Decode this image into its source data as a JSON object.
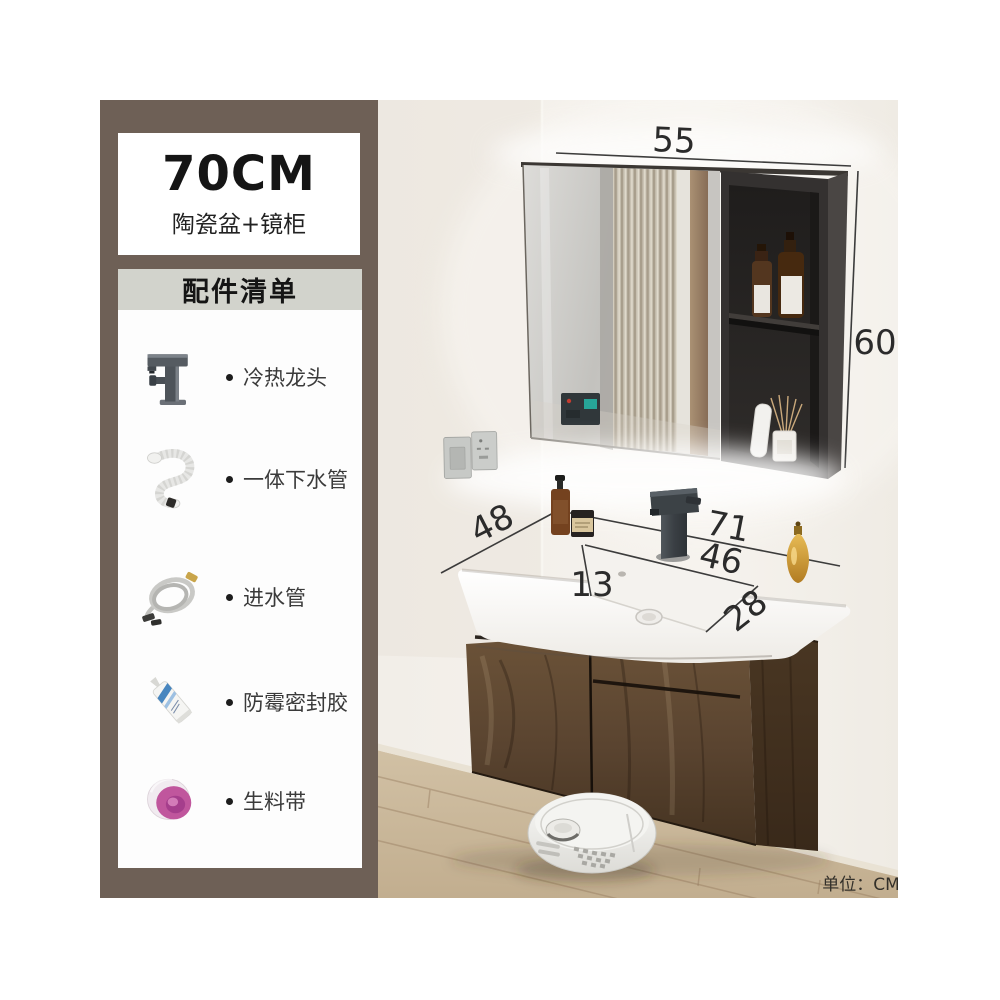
{
  "sidebar": {
    "size_card": {
      "size": "70CM",
      "subtitle": "陶瓷盆+镜柜"
    },
    "accessories": {
      "header": "配件清单",
      "items": [
        {
          "label": "冷热龙头",
          "icon": "faucet-icon"
        },
        {
          "label": "一体下水管",
          "icon": "drain-pipe-icon"
        },
        {
          "label": "进水管",
          "icon": "water-inlet-hose-icon"
        },
        {
          "label": "防霉密封胶",
          "icon": "sealant-tube-icon"
        },
        {
          "label": "生料带",
          "icon": "thread-seal-tape-icon"
        }
      ]
    }
  },
  "scene": {
    "dimensions": {
      "mirror_cabinet_width_cm": "55",
      "mirror_cabinet_height_cm": "60",
      "countertop_depth_cm": "48",
      "countertop_width_cm": "71",
      "basin_inner_width_cm": "46",
      "basin_left_offset_cm": "13",
      "basin_inner_depth_cm": "28"
    },
    "unit_note": "单位：CM"
  },
  "colors": {
    "sidebar_bg": "#6e6056",
    "accessories_header_bg": "#d2d3cc",
    "card_bg": "#ffffff",
    "wall": "#f2eee8",
    "wood_cabinet": "#5d4631",
    "floor": "#cdbb9f",
    "dimension_line": "#2d2d2d",
    "tape_pink": "#c0569d",
    "gold_bottle": "#d9a83c"
  }
}
